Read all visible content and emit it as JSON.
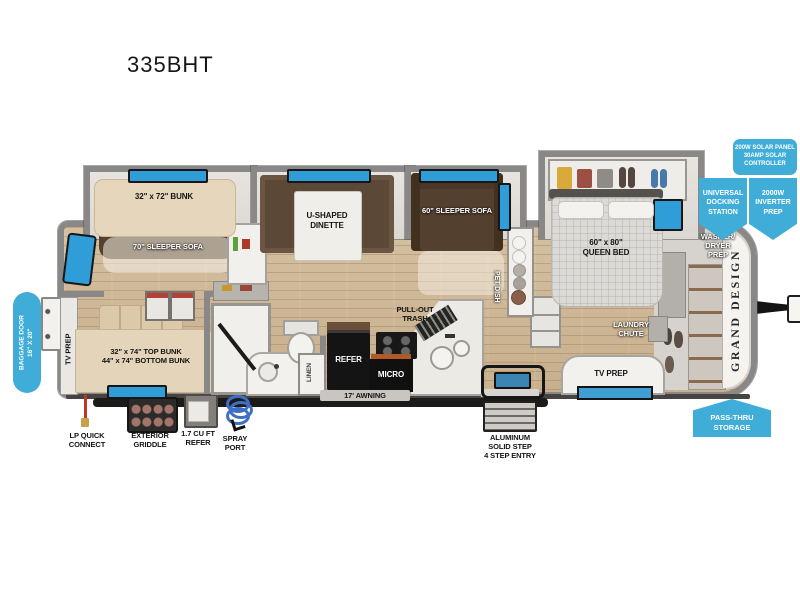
{
  "title": "335BHT",
  "colors": {
    "badge_blue": "#3fadd8",
    "window_blue": "#2f9ed8",
    "wall_gray": "#8a8886",
    "floor_wood": "#cdb697",
    "sofa_brown": "#54402e",
    "appliance_black": "#141414"
  },
  "plan": {
    "bunk_slide": "32\" x 72\" BUNK",
    "sofa70": "70\" SLEEPER SOFA",
    "dinette": "U-SHAPED\nDINETTE",
    "sofa60": "60\" SLEEPER SOFA",
    "queen_bed": "60\" x 80\"\nQUEEN BED",
    "bunks": "32\" x 74\" TOP BUNK\n44\" x 74\" BOTTOM BUNK",
    "tv_prep_left": "TV PREP",
    "tv_prep_bedroom": "TV PREP",
    "pet_dish": "PET DISH",
    "linen": "LINEN",
    "pull_out_trash": "PULL-OUT\nTRASH",
    "refer": "REFER",
    "micro": "MICRO",
    "awning": "17' AWNING",
    "laundry_chute": "LAUNDRY\nCHUTE",
    "washer_dryer": "WASHER/\nDRYER\nPREP",
    "brand": "GRAND DESIGN"
  },
  "badges": {
    "baggage_door": "BAGGAGE DOOR\n16\" X 20\"",
    "solar": "200W SOLAR PANEL\n30AMP SOLAR\nCONTROLLER",
    "docking_station": "UNIVERSAL\nDOCKING\nSTATION",
    "inverter_prep": "2000W\nINVERTER\nPREP",
    "pass_thru": "PASS-THRU\nSTORAGE"
  },
  "callouts": {
    "lp_quick_connect": "LP QUICK\nCONNECT",
    "exterior_griddle": "EXTERIOR\nGRIDDLE",
    "refer_small": "1.7 CU FT\nREFER",
    "spray_port": "SPRAY\nPORT",
    "solid_step": "ALUMINUM\nSOLID STEP\n4 STEP ENTRY"
  }
}
